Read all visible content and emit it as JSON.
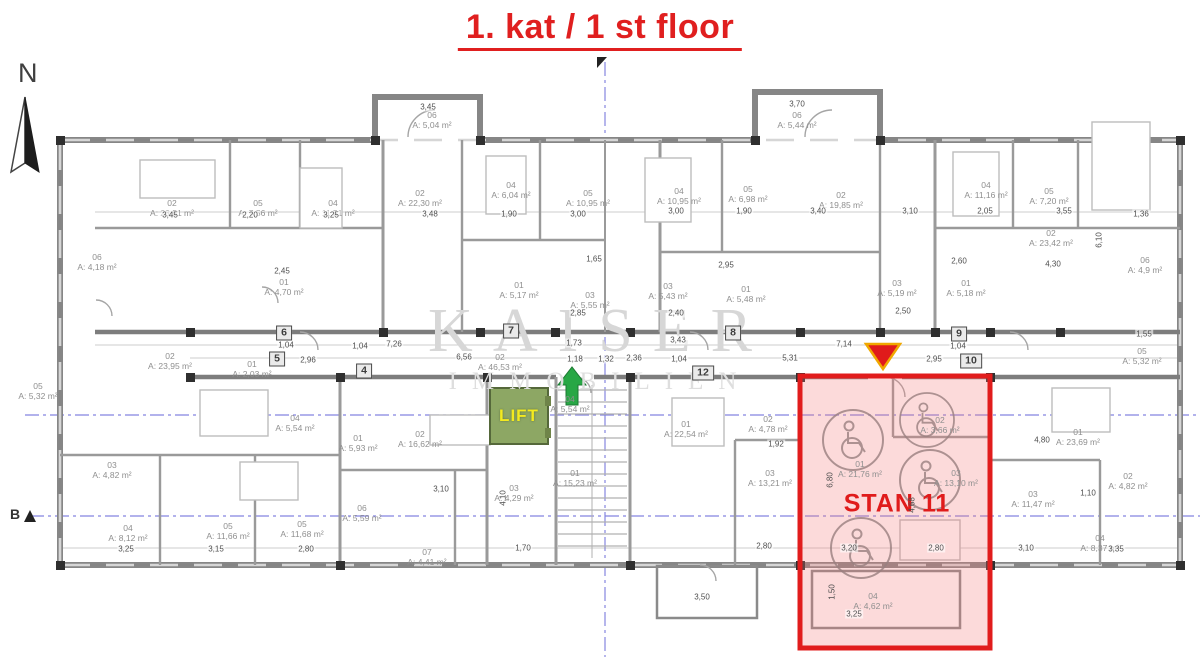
{
  "title": {
    "text": "1. kat / 1 st floor"
  },
  "compass": {
    "label": "N"
  },
  "section_marker": {
    "label": "B"
  },
  "watermark": {
    "line1": "KAISER",
    "line2": "IMMOBILIEN"
  },
  "lift": {
    "label": "LIFT"
  },
  "stan11": {
    "label": "STAN 11"
  },
  "colors": {
    "accent_red": "#e01f1f",
    "stan_fill_pink": "#f4a9a9",
    "stan_border": "#e11c1c",
    "lift_green": "#8da764",
    "lift_text_yellow": "#f3ea1f",
    "arrow_green": "#28a745",
    "marker_yellow_border": "#f0a800",
    "axis_blue": "#8585e0",
    "wall_gray": "#868686",
    "label_gray": "#8f8f8f",
    "watermark_gray": "#d7d7d7"
  },
  "rooms": [
    {
      "i": "02",
      "a": "A: 23,51 m²",
      "x": 172,
      "y": 208
    },
    {
      "i": "05",
      "a": "A: 7,56 m²",
      "x": 258,
      "y": 208
    },
    {
      "i": "04",
      "a": "A: 11,51 m²",
      "x": 333,
      "y": 208
    },
    {
      "i": "06",
      "a": "A: 4,18 m²",
      "x": 97,
      "y": 262
    },
    {
      "i": "01",
      "a": "A: 4,70 m²",
      "x": 284,
      "y": 287
    },
    {
      "i": "06",
      "a": "A: 5,04 m²",
      "x": 432,
      "y": 120
    },
    {
      "i": "02",
      "a": "A: 22,30 m²",
      "x": 420,
      "y": 198
    },
    {
      "i": "04",
      "a": "A: 6,04 m²",
      "x": 511,
      "y": 190
    },
    {
      "i": "05",
      "a": "A: 10,95 m²",
      "x": 588,
      "y": 198
    },
    {
      "i": "01",
      "a": "A: 5,17 m²",
      "x": 519,
      "y": 290
    },
    {
      "i": "03",
      "a": "A: 5,55 m²",
      "x": 590,
      "y": 300
    },
    {
      "i": "06",
      "a": "A: 5,44 m²",
      "x": 797,
      "y": 120
    },
    {
      "i": "04",
      "a": "A: 10,95 m²",
      "x": 679,
      "y": 196
    },
    {
      "i": "05",
      "a": "A: 6,98 m²",
      "x": 748,
      "y": 194
    },
    {
      "i": "02",
      "a": "A: 19,85 m²",
      "x": 841,
      "y": 200
    },
    {
      "i": "03",
      "a": "A: 5,43 m²",
      "x": 668,
      "y": 291
    },
    {
      "i": "01",
      "a": "A: 5,48 m²",
      "x": 746,
      "y": 294
    },
    {
      "i": "03",
      "a": "A: 5,19 m²",
      "x": 897,
      "y": 288
    },
    {
      "i": "04",
      "a": "A: 11,16 m²",
      "x": 986,
      "y": 190
    },
    {
      "i": "05",
      "a": "A: 7,20 m²",
      "x": 1049,
      "y": 196
    },
    {
      "i": "02",
      "a": "A: 23,42 m²",
      "x": 1051,
      "y": 238
    },
    {
      "i": "06",
      "a": "A: 4,9 m²",
      "x": 1145,
      "y": 265
    },
    {
      "i": "01",
      "a": "A: 5,18 m²",
      "x": 966,
      "y": 288
    },
    {
      "i": "02",
      "a": "A: 23,95 m²",
      "x": 170,
      "y": 361
    },
    {
      "i": "01",
      "a": "A: 2,03 m²",
      "x": 252,
      "y": 369
    },
    {
      "i": "02",
      "a": "A: 46,53 m²",
      "x": 500,
      "y": 362
    },
    {
      "i": "04",
      "a": "A: 5,54 m²",
      "x": 295,
      "y": 423
    },
    {
      "i": "04",
      "a": "A: 5,54 m²",
      "x": 570,
      "y": 404
    },
    {
      "i": "03",
      "a": "A: 4,82 m²",
      "x": 112,
      "y": 470
    },
    {
      "i": "04",
      "a": "A: 8,12 m²",
      "x": 128,
      "y": 533
    },
    {
      "i": "05",
      "a": "A: 11,66 m²",
      "x": 228,
      "y": 531
    },
    {
      "i": "05",
      "a": "A: 11,68 m²",
      "x": 302,
      "y": 529
    },
    {
      "i": "01",
      "a": "A: 5,93 m²",
      "x": 358,
      "y": 443
    },
    {
      "i": "02",
      "a": "A: 16,62 m²",
      "x": 420,
      "y": 439
    },
    {
      "i": "06",
      "a": "A: 5,59 m²",
      "x": 362,
      "y": 513
    },
    {
      "i": "07",
      "a": "A: 4,41 m²",
      "x": 427,
      "y": 557
    },
    {
      "i": "03",
      "a": "A: 4,29 m²",
      "x": 514,
      "y": 493
    },
    {
      "i": "01",
      "a": "A: 15,23 m²",
      "x": 575,
      "y": 478
    },
    {
      "i": "01",
      "a": "A: 22,54 m²",
      "x": 686,
      "y": 429
    },
    {
      "i": "02",
      "a": "A: 4,78 m²",
      "x": 768,
      "y": 424
    },
    {
      "i": "03",
      "a": "A: 13,21 m²",
      "x": 770,
      "y": 478
    },
    {
      "i": "01",
      "a": "A: 21,76 m²",
      "x": 860,
      "y": 469
    },
    {
      "i": "02",
      "a": "A: 3,66 m²",
      "x": 940,
      "y": 425
    },
    {
      "i": "03",
      "a": "A: 13,10 m²",
      "x": 956,
      "y": 478
    },
    {
      "i": "04",
      "a": "A: 4,62 m²",
      "x": 873,
      "y": 601
    },
    {
      "i": "01",
      "a": "A: 23,69 m²",
      "x": 1078,
      "y": 437
    },
    {
      "i": "02",
      "a": "A: 4,82 m²",
      "x": 1128,
      "y": 481
    },
    {
      "i": "03",
      "a": "A: 11,47 m²",
      "x": 1033,
      "y": 499
    },
    {
      "i": "04",
      "a": "A: 8,37 m²",
      "x": 1100,
      "y": 543
    },
    {
      "i": "05",
      "a": "A: 5,32 m²",
      "x": 1142,
      "y": 356
    },
    {
      "i": "05",
      "a": "A: 5,32 m²",
      "x": 38,
      "y": 391
    }
  ],
  "corridor_nodes": [
    {
      "n": "6",
      "x": 284,
      "y": 333
    },
    {
      "n": "5",
      "x": 277,
      "y": 359
    },
    {
      "n": "4",
      "x": 364,
      "y": 371
    },
    {
      "n": "7",
      "x": 511,
      "y": 331
    },
    {
      "n": "8",
      "x": 733,
      "y": 333
    },
    {
      "n": "12",
      "x": 703,
      "y": 373
    },
    {
      "n": "9",
      "x": 959,
      "y": 334
    },
    {
      "n": "10",
      "x": 971,
      "y": 361
    }
  ],
  "dimensions": [
    {
      "t": "3,45",
      "x": 170,
      "y": 215
    },
    {
      "t": "2,20",
      "x": 250,
      "y": 215
    },
    {
      "t": "3,25",
      "x": 331,
      "y": 215
    },
    {
      "t": "2,45",
      "x": 282,
      "y": 271
    },
    {
      "t": "3,45",
      "x": 428,
      "y": 107
    },
    {
      "t": "3,48",
      "x": 430,
      "y": 214
    },
    {
      "t": "1,90",
      "x": 509,
      "y": 214
    },
    {
      "t": "3,00",
      "x": 578,
      "y": 214
    },
    {
      "t": "3,70",
      "x": 797,
      "y": 104
    },
    {
      "t": "3,00",
      "x": 676,
      "y": 211
    },
    {
      "t": "1,90",
      "x": 744,
      "y": 211
    },
    {
      "t": "3,40",
      "x": 818,
      "y": 211
    },
    {
      "t": "2,95",
      "x": 726,
      "y": 265
    },
    {
      "t": "3,10",
      "x": 910,
      "y": 211
    },
    {
      "t": "2,05",
      "x": 985,
      "y": 211
    },
    {
      "t": "3,55",
      "x": 1064,
      "y": 211
    },
    {
      "t": "1,36",
      "x": 1141,
      "y": 214
    },
    {
      "t": "2,60",
      "x": 959,
      "y": 261
    },
    {
      "t": "4,30",
      "x": 1053,
      "y": 264
    },
    {
      "t": "6,10",
      "x": 1099,
      "y": 240,
      "r": 1
    },
    {
      "t": "1,65",
      "x": 594,
      "y": 259
    },
    {
      "t": "2,85",
      "x": 578,
      "y": 313
    },
    {
      "t": "2,40",
      "x": 676,
      "y": 313
    },
    {
      "t": "2,50",
      "x": 903,
      "y": 311
    },
    {
      "t": "6,56",
      "x": 464,
      "y": 357
    },
    {
      "t": "7,26",
      "x": 394,
      "y": 344
    },
    {
      "t": "1,04",
      "x": 286,
      "y": 345
    },
    {
      "t": "2,96",
      "x": 308,
      "y": 360
    },
    {
      "t": "1,04",
      "x": 360,
      "y": 346
    },
    {
      "t": "1,73",
      "x": 574,
      "y": 343
    },
    {
      "t": "1,18",
      "x": 575,
      "y": 359
    },
    {
      "t": "1,32",
      "x": 606,
      "y": 359
    },
    {
      "t": "2,36",
      "x": 634,
      "y": 358
    },
    {
      "t": "1,04",
      "x": 679,
      "y": 359
    },
    {
      "t": "3,43",
      "x": 678,
      "y": 340
    },
    {
      "t": "7,14",
      "x": 844,
      "y": 344
    },
    {
      "t": "5,31",
      "x": 790,
      "y": 358
    },
    {
      "t": "2,95",
      "x": 934,
      "y": 359
    },
    {
      "t": "1,04",
      "x": 958,
      "y": 346
    },
    {
      "t": "1,55",
      "x": 1144,
      "y": 334
    },
    {
      "t": "3,25",
      "x": 126,
      "y": 549
    },
    {
      "t": "3,15",
      "x": 216,
      "y": 549
    },
    {
      "t": "2,80",
      "x": 306,
      "y": 549
    },
    {
      "t": "3,10",
      "x": 441,
      "y": 489
    },
    {
      "t": "4,10",
      "x": 503,
      "y": 498,
      "r": 1
    },
    {
      "t": "1,70",
      "x": 523,
      "y": 548
    },
    {
      "t": "1,92",
      "x": 776,
      "y": 444
    },
    {
      "t": "2,80",
      "x": 764,
      "y": 546
    },
    {
      "t": "6,80",
      "x": 830,
      "y": 480,
      "r": 1
    },
    {
      "t": "4,68",
      "x": 912,
      "y": 505,
      "r": 1
    },
    {
      "t": "3,20",
      "x": 849,
      "y": 548
    },
    {
      "t": "2,80",
      "x": 936,
      "y": 548
    },
    {
      "t": "3,25",
      "x": 854,
      "y": 614
    },
    {
      "t": "1,50",
      "x": 832,
      "y": 592,
      "r": 1
    },
    {
      "t": "3,50",
      "x": 702,
      "y": 597
    },
    {
      "t": "4,80",
      "x": 1042,
      "y": 440
    },
    {
      "t": "1,10",
      "x": 1088,
      "y": 493
    },
    {
      "t": "3,10",
      "x": 1026,
      "y": 548
    },
    {
      "t": "3,35",
      "x": 1116,
      "y": 549
    }
  ]
}
